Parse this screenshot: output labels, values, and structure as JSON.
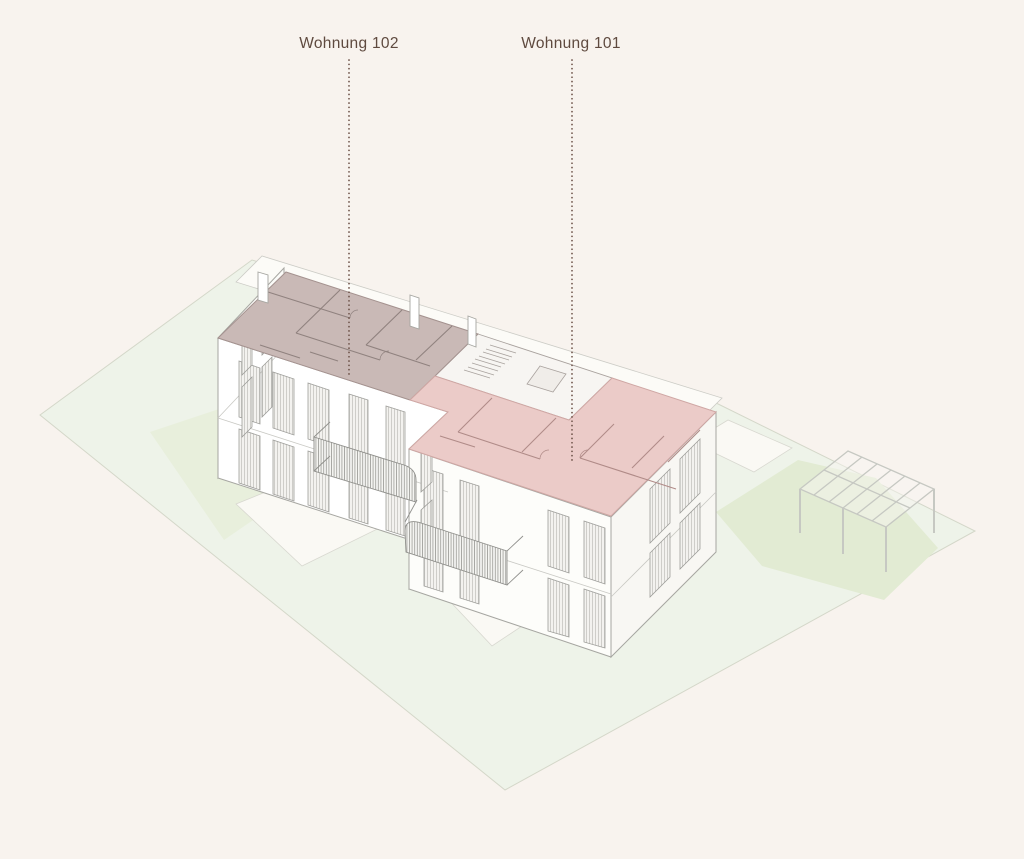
{
  "background_color": "#f8f3ee",
  "apartments": [
    {
      "id": "102",
      "label": "Wohnung 102",
      "fill": "#c9b9b6"
    },
    {
      "id": "101",
      "label": "Wohnung 101",
      "fill": "#ebcbc8"
    }
  ],
  "colors": {
    "label_text": "#5f4a3f",
    "leader_line": "#6b5046",
    "site_green": "#eef3e9",
    "site_edge": "#d4d7c9",
    "lawn_patch": "#e2ebd3",
    "lawn_patch_light": "#e8efdc",
    "patio_fill": "#faf9f4",
    "walkway_fill": "#fcfbf7",
    "building_fill": "#ffffff",
    "building_line": "#a6a6a1",
    "stairwell_fill": "#f7f5f2",
    "apartment_102_wall_line": "#90827f",
    "apartment_101_wall_line": "#b08b88"
  }
}
